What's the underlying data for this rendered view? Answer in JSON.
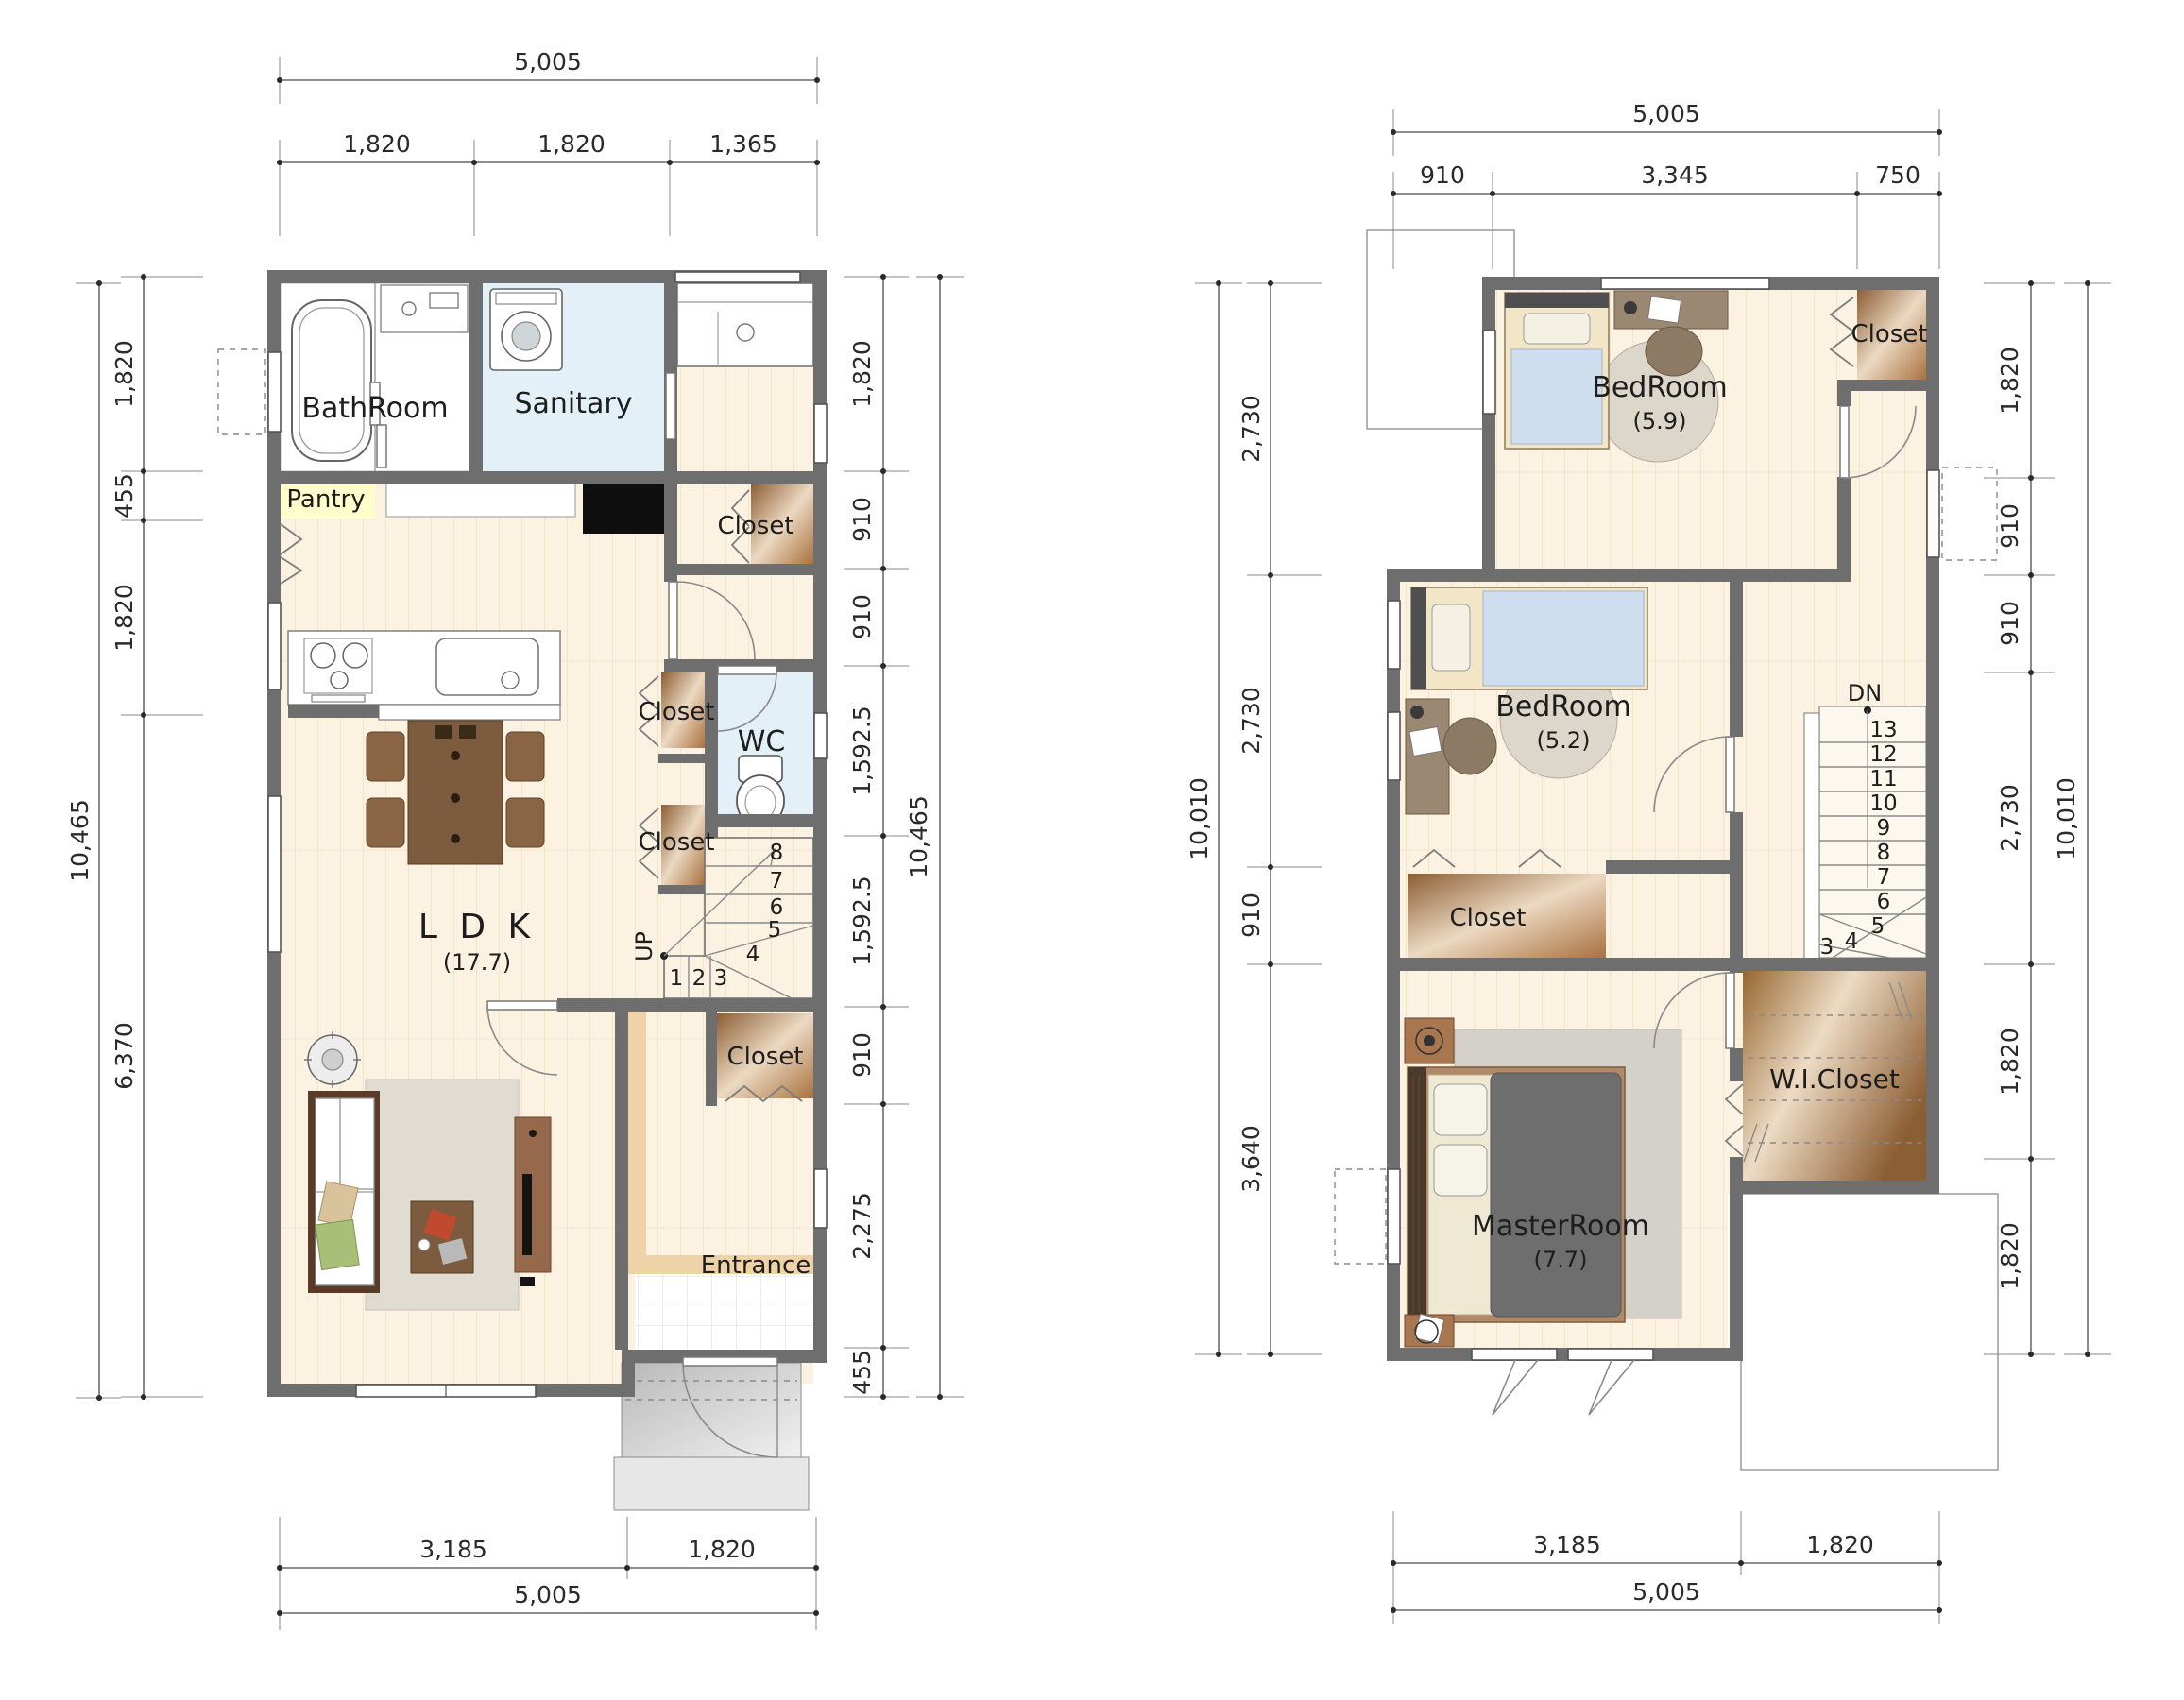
{
  "title": "House floor plans 1F and 2F",
  "colors": {
    "wall": "#6f6e6e",
    "wood_floor": "#fbf2e1",
    "water_room": "#e3f0f7",
    "closet_dark": "#8c5e33",
    "closet_light": "#ecd9c2",
    "entrance_step": "#eed3a8",
    "porch_gray": "#c3c3c3",
    "pantry_highlight": "#ffffcc",
    "bed_blue": "#cfdeee",
    "rug_gray": "#ddd6ca",
    "duvet_gray": "#6e6e6e"
  },
  "floor1": {
    "rooms": {
      "bathroom": "BathRoom",
      "sanitary": "Sanitary",
      "pantry": "Pantry",
      "closet_hall": "Closet",
      "wc": "WC",
      "closet_mid_upper": "Closet",
      "closet_mid_lower": "Closet",
      "ldk": "L D K",
      "ldk_area": "(17.7)",
      "up": "UP",
      "closet_entrance": "Closet",
      "entrance": "Entrance"
    },
    "steps": [
      "1",
      "2",
      "3",
      "4",
      "5",
      "6",
      "7",
      "8"
    ],
    "dims": {
      "top_total": "5,005",
      "top": [
        "1,820",
        "1,820",
        "1,365"
      ],
      "left_total": "10,465",
      "left": [
        "1,820",
        "455",
        "1,820",
        "6,370"
      ],
      "right_total": "10,465",
      "right": [
        "1,820",
        "910",
        "910",
        "1,592.5",
        "1,592.5",
        "910",
        "2,275",
        "455"
      ],
      "bottom_total": "5,005",
      "bottom": [
        "3,185",
        "1,820"
      ]
    }
  },
  "floor2": {
    "rooms": {
      "bedroom1": "BedRoom",
      "bedroom1_area": "(5.9)",
      "closet_bedroom1": "Closet",
      "bedroom2": "BedRoom",
      "bedroom2_area": "(5.2)",
      "closet_bedroom2": "Closet",
      "dn": "DN",
      "wic": "W.I.Closet",
      "master": "MasterRoom",
      "master_area": "(7.7)"
    },
    "steps": [
      "3",
      "4",
      "5",
      "6",
      "7",
      "8",
      "9",
      "10",
      "11",
      "12",
      "13"
    ],
    "dims": {
      "top_total": "5,005",
      "top": [
        "910",
        "3,345",
        "750"
      ],
      "left_total": "10,010",
      "left": [
        "2,730",
        "2,730",
        "910",
        "3,640"
      ],
      "right_total": "10,010",
      "right": [
        "1,820",
        "910",
        "910",
        "2,730",
        "1,820",
        "1,820"
      ],
      "bottom_total": "5,005",
      "bottom": [
        "3,185",
        "1,820"
      ]
    }
  }
}
